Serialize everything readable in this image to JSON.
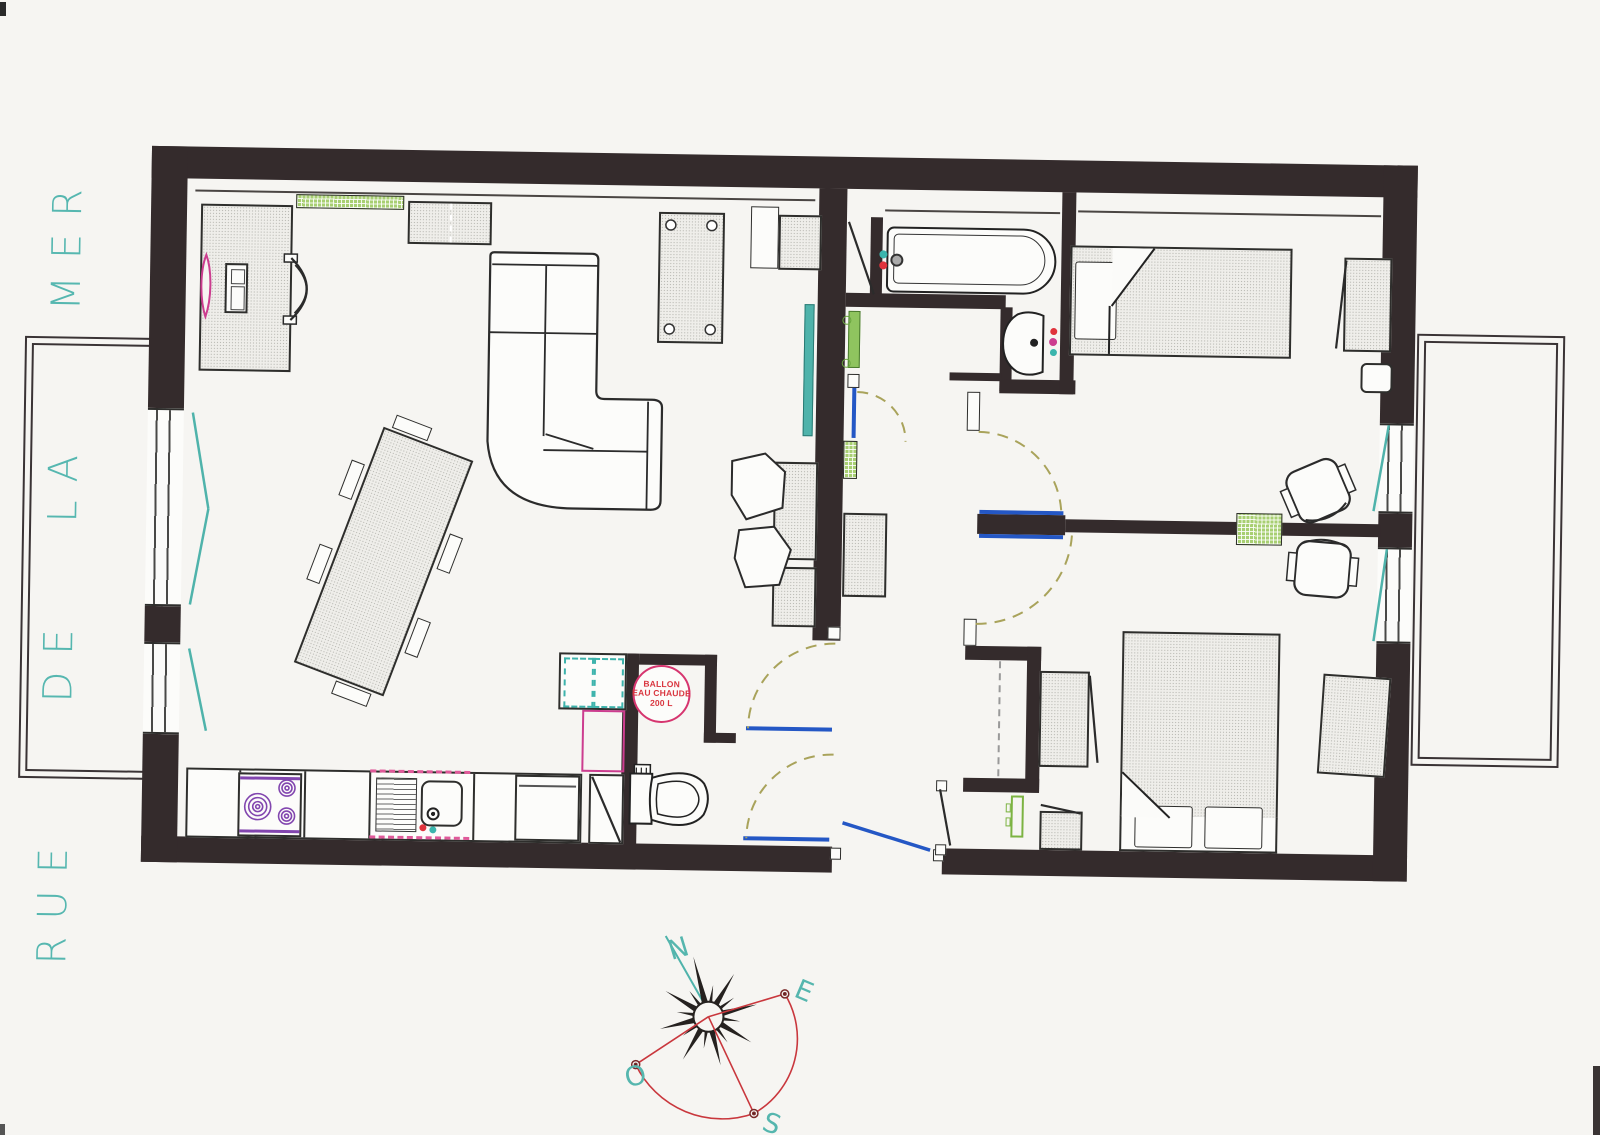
{
  "document": {
    "type": "scanned apartment floor plan"
  },
  "street_label": {
    "full": "RUE DE LA MER",
    "words": [
      "RUE",
      "DE",
      "LA",
      "MER"
    ],
    "color": "#56b7b0"
  },
  "water_heater": {
    "lines": [
      "BALLON",
      "EAU CHAUDE",
      "200 L"
    ],
    "text_color": "#d9363f",
    "ring_color": "#d6356f"
  },
  "compass": {
    "north": "N",
    "east": "E",
    "south": "S",
    "west": "O",
    "letter_color": "#55b6ae",
    "rose_color": "#25211f",
    "arc_color": "#c9373d"
  },
  "palette": {
    "paper": "#f6f5f2",
    "wall": "#342b2c",
    "hatch_fill": "#efeeea",
    "green": "#8fc45f",
    "teal": "#4fb3ab",
    "blue": "#2457c5",
    "olive_door_arc": "#a9a35b",
    "magenta": "#cc3d8f",
    "purple": "#8246af",
    "red": "#e0333c"
  },
  "fixture_icons": [
    "desk",
    "desk-lamp",
    "computer-tower",
    "office-chair",
    "radiator",
    "wall-cabinet",
    "sectional-sofa",
    "side-table",
    "dining-table",
    "dining-chair",
    "armchair",
    "tv-panel",
    "kitchen-counter",
    "cooktop",
    "drainboard",
    "kitchen-sink",
    "fridge",
    "hot-water-tank",
    "toilet",
    "bathtub",
    "washbasin",
    "towel-radiator",
    "single-bed",
    "double-bed",
    "pillow",
    "wardrobe",
    "nightstand",
    "desk-chair",
    "closet",
    "front-door",
    "door-swing",
    "window",
    "balcony",
    "compass-rose"
  ]
}
